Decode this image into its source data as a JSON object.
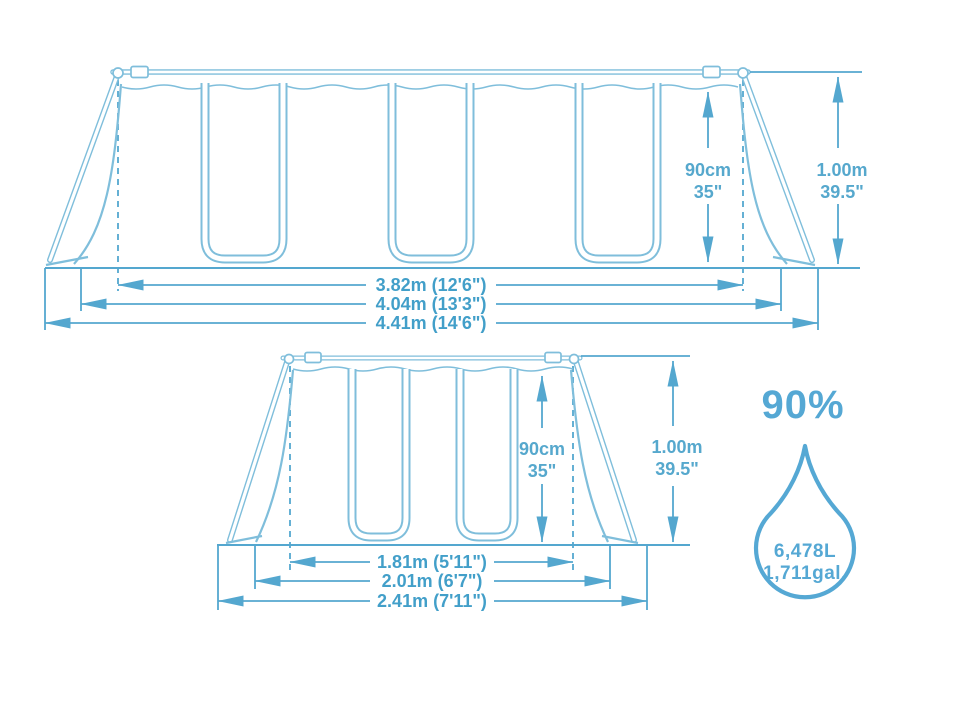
{
  "diagram": {
    "top_view": {
      "name": "pool side view",
      "inner_height": {
        "metric": "90cm",
        "imperial": "35\""
      },
      "outer_height": {
        "metric": "1.00m",
        "imperial": "39.5\""
      },
      "lengths": [
        "3.82m (12'6\")",
        "4.04m (13'3\")",
        "4.41m (14'6\")"
      ]
    },
    "end_view": {
      "name": "pool end view",
      "inner_height": {
        "metric": "90cm",
        "imperial": "35\""
      },
      "outer_height": {
        "metric": "1.00m",
        "imperial": "39.5\""
      },
      "widths": [
        "1.81m (5'11\")",
        "2.01m (6'7\")",
        "2.41m (7'11\")"
      ]
    },
    "capacity": {
      "fill_percent": "90%",
      "liters": "6,478L",
      "gallons": "1,711gal."
    },
    "colors": {
      "structure_line": "#7fbedb",
      "dimension_line": "#54a7cf",
      "dimension_text": "#429fc9",
      "accent": "#55a8d4",
      "background": "#ffffff"
    }
  }
}
